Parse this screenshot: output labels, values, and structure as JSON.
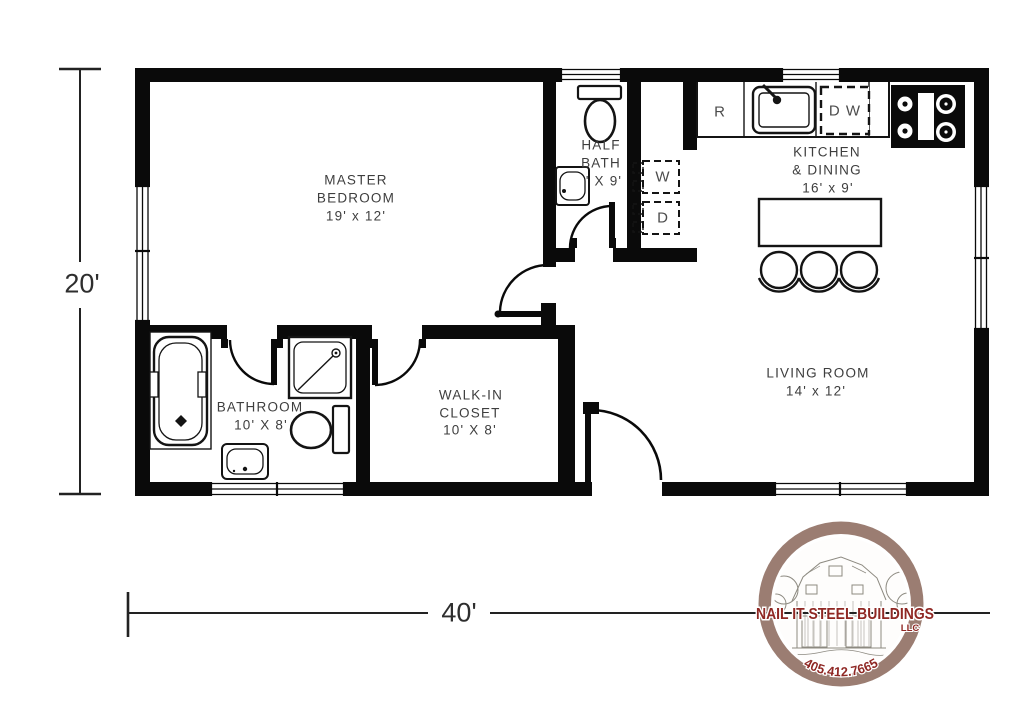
{
  "plan": {
    "type": "floor-plan",
    "overall_width_label": "40'",
    "overall_height_label": "20'"
  },
  "rooms": {
    "master_bedroom": {
      "line1": "MASTER",
      "line2": "BEDROOM",
      "size": "19' x 12'"
    },
    "half_bath": {
      "line1": "HALF",
      "line2": "BATH",
      "size": "' X 9'"
    },
    "kitchen_dining": {
      "line1": "KITCHEN",
      "line2": "& DINING",
      "size": "16' x 9'"
    },
    "bathroom": {
      "line1": "BATHROOM",
      "size": "10' X 8'"
    },
    "walk_in_closet": {
      "line1": "WALK-IN",
      "line2": "CLOSET",
      "size": "10' X 8'"
    },
    "living_room": {
      "line1": "LIVING ROOM",
      "size": "14' x 12'"
    }
  },
  "appliances": {
    "refrigerator": "R",
    "washer": "W",
    "dryer": "D",
    "dishwasher": "D W"
  },
  "logo": {
    "company": "NAIL IT STEEL BUILDINGS",
    "entity": "LLC",
    "phone": "405.412.7665",
    "ring_color": "#9b7d72",
    "text_color": "#8f2723"
  },
  "colors": {
    "wall": "#0a0a0a",
    "label": "#3e3e3e",
    "background": "#ffffff"
  }
}
